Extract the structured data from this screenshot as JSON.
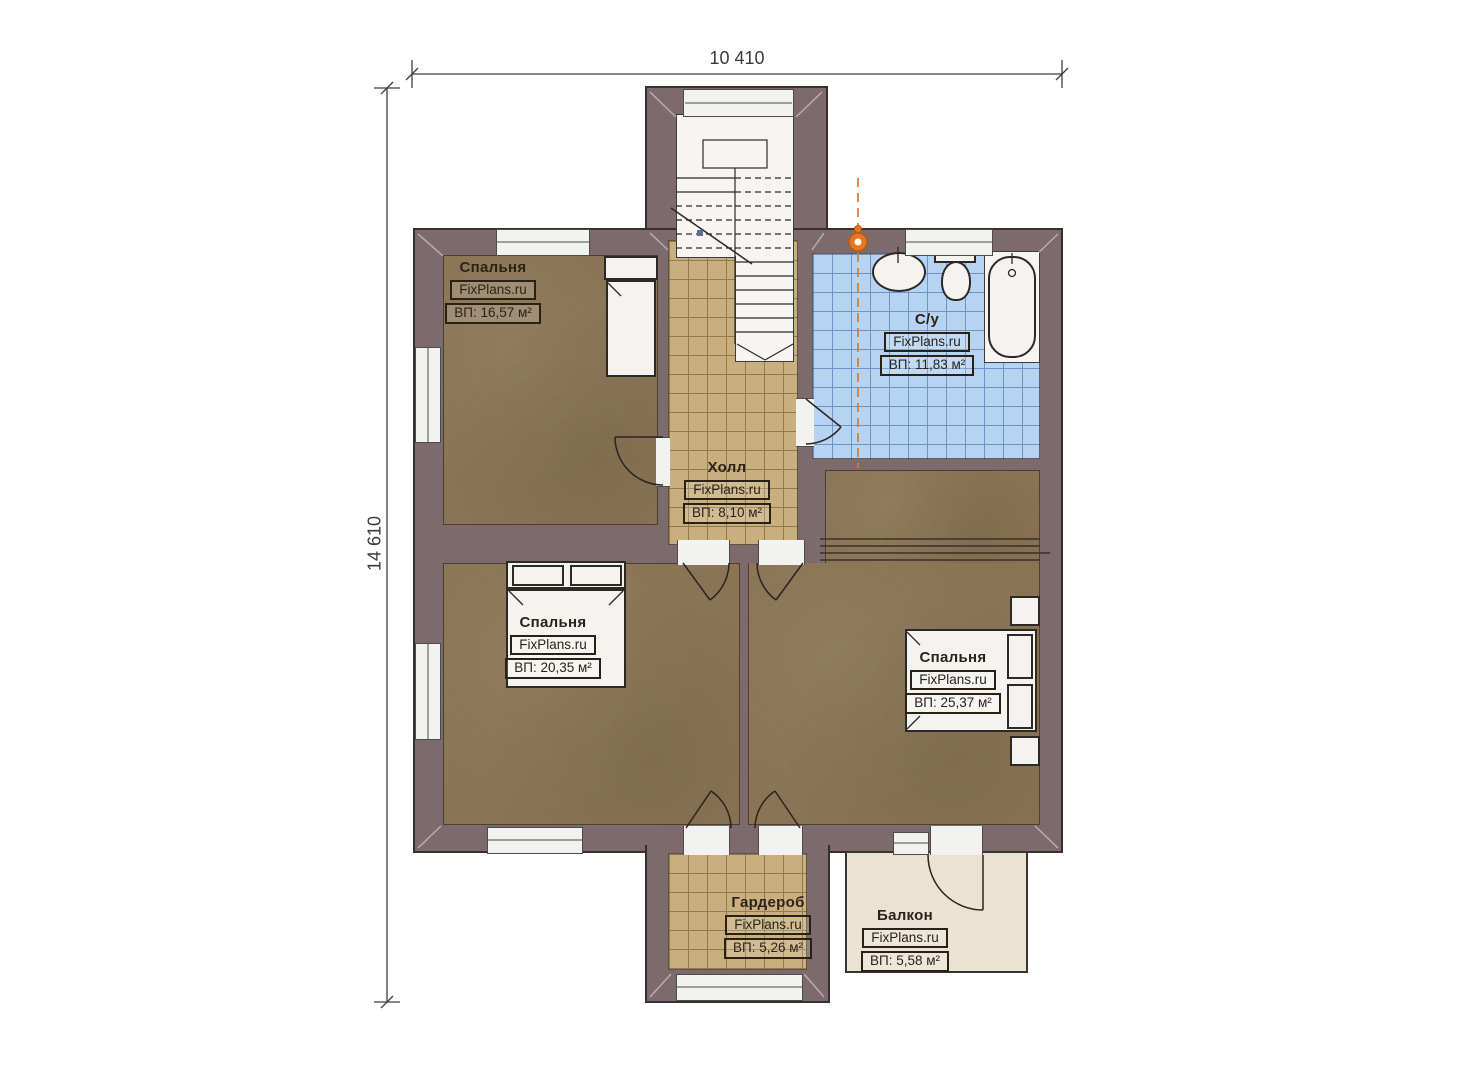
{
  "branding": "FixPlans.ru",
  "dimensions": {
    "top": "10 410",
    "left": "14 610"
  },
  "rooms": [
    {
      "id": "bedroom-top-left",
      "name": "Спальня",
      "area_label": "ВП: 16,57 м²"
    },
    {
      "id": "bathroom",
      "name": "С/у",
      "area_label": "ВП: 11,83 м²"
    },
    {
      "id": "hall",
      "name": "Холл",
      "area_label": "ВП: 8,10 м²"
    },
    {
      "id": "bedroom-middle-left",
      "name": "Спальня",
      "area_label": "ВП: 20,35 м²"
    },
    {
      "id": "bedroom-right",
      "name": "Спальня",
      "area_label": "ВП: 25,37 м²"
    },
    {
      "id": "wardrobe",
      "name": "Гардероб",
      "area_label": "ВП: 5,26 м²"
    },
    {
      "id": "balcony",
      "name": "Балкон",
      "area_label": "ВП: 5,58 м²"
    }
  ],
  "colors": {
    "wall": "#7D6A6C",
    "floor_brown": "#8A7455",
    "tile_tan": "#C9AE7E",
    "tile_blue": "#B7D3F2",
    "balcony": "#EAE3D2",
    "accent_orange": "#E8761F"
  }
}
